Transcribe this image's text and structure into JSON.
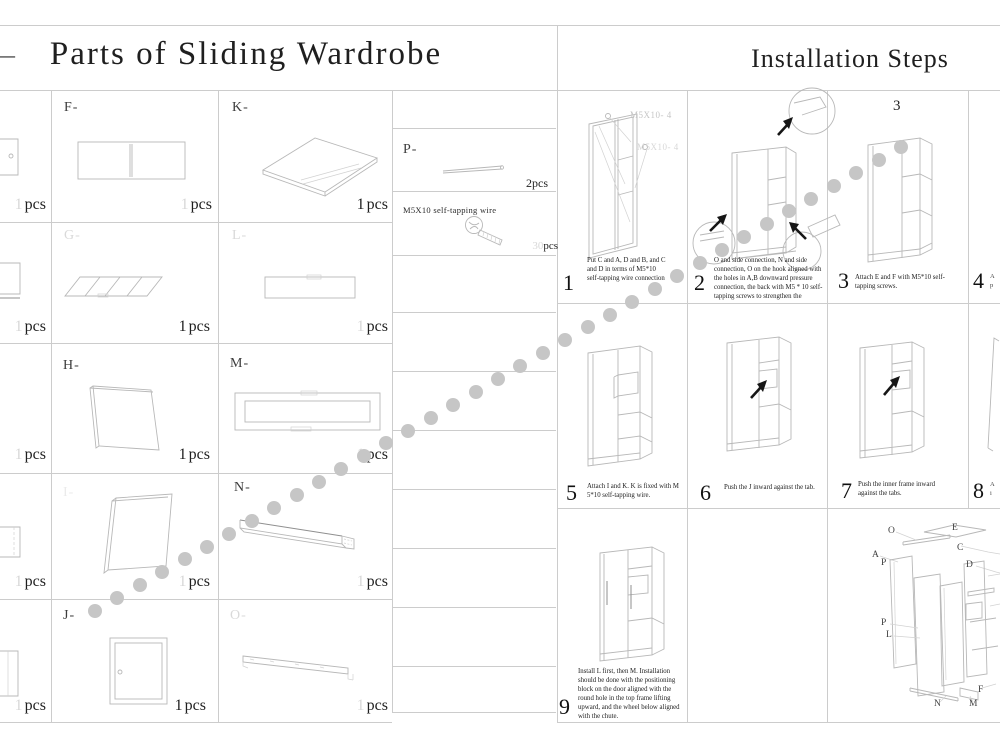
{
  "header": {
    "left_title": "Parts of Sliding Wardrobe",
    "right_title": "Installation Steps",
    "left_edge_mark": "—"
  },
  "parts": {
    "unit": "pcs",
    "partials": [
      {
        "qty": "1"
      },
      {
        "qty": "1"
      },
      {
        "qty": "1"
      },
      {
        "qty": "1"
      },
      {
        "qty": "1"
      }
    ],
    "cells": [
      {
        "id": "F",
        "label": "F-",
        "qty": "1"
      },
      {
        "id": "K",
        "label": "K-",
        "qty": "1"
      },
      {
        "id": "G",
        "label": "G-",
        "qty": "1"
      },
      {
        "id": "L",
        "label": "L-",
        "qty": "1"
      },
      {
        "id": "H",
        "label": "H-",
        "qty": "1"
      },
      {
        "id": "M",
        "label": "M-",
        "qty": "1"
      },
      {
        "id": "I",
        "label": "I-",
        "qty": "1"
      },
      {
        "id": "N",
        "label": "N-",
        "qty": "1"
      },
      {
        "id": "J",
        "label": "J-",
        "qty": "1"
      },
      {
        "id": "O",
        "label": "O-",
        "qty": "1"
      }
    ],
    "rod": {
      "label": "P-",
      "qty": "2",
      "unit": "pcs"
    },
    "screw": {
      "label": "M5X10 self-tapping wire",
      "qty": "30",
      "unit": "pcs"
    }
  },
  "steps": {
    "s1": {
      "num": "1",
      "ann1": "M5X10- 4",
      "ann2": "M5X10- 4",
      "text": "Put C and A, D and B, and C and D in terms of M5*10 self-tapping wire connection"
    },
    "s2": {
      "num": "2",
      "text": "O and side connection, N and side connection, O on the hook aligned with the holes in A,B downward pressure connection, the back with M5 * 10 self-tapping screws to strengthen the"
    },
    "s3": {
      "num": "3",
      "header": "3",
      "text": "Attach E and F with M5*10 self-tapping screws."
    },
    "s4": {
      "num": "4",
      "frag1": "A",
      "frag2": "p"
    },
    "s5": {
      "num": "5",
      "text": "Attach I and K. K is fixed with M 5*10 self-tapping wire."
    },
    "s6": {
      "num": "6",
      "text": "Push the J inward against the tab."
    },
    "s7": {
      "num": "7",
      "text": "Push the inner frame inward against the tabs."
    },
    "s8": {
      "num": "8",
      "frag1": "A",
      "frag2": "i"
    },
    "s9": {
      "num": "9",
      "text": "Install L first, then M. Installation should be done with the positioning block on the door aligned with the round hole in the top frame lifting upward, and the wheel below aligned with the chute."
    }
  },
  "exploded": {
    "labels": [
      "O",
      "E",
      "C",
      "A",
      "P",
      "D",
      "P",
      "L",
      "F",
      "N",
      "M"
    ]
  },
  "dots": {
    "count": 37,
    "start_x": 95,
    "start_y": 611,
    "end_x": 901,
    "end_y": 147,
    "radius": 7,
    "color": "#c6c6c6"
  }
}
